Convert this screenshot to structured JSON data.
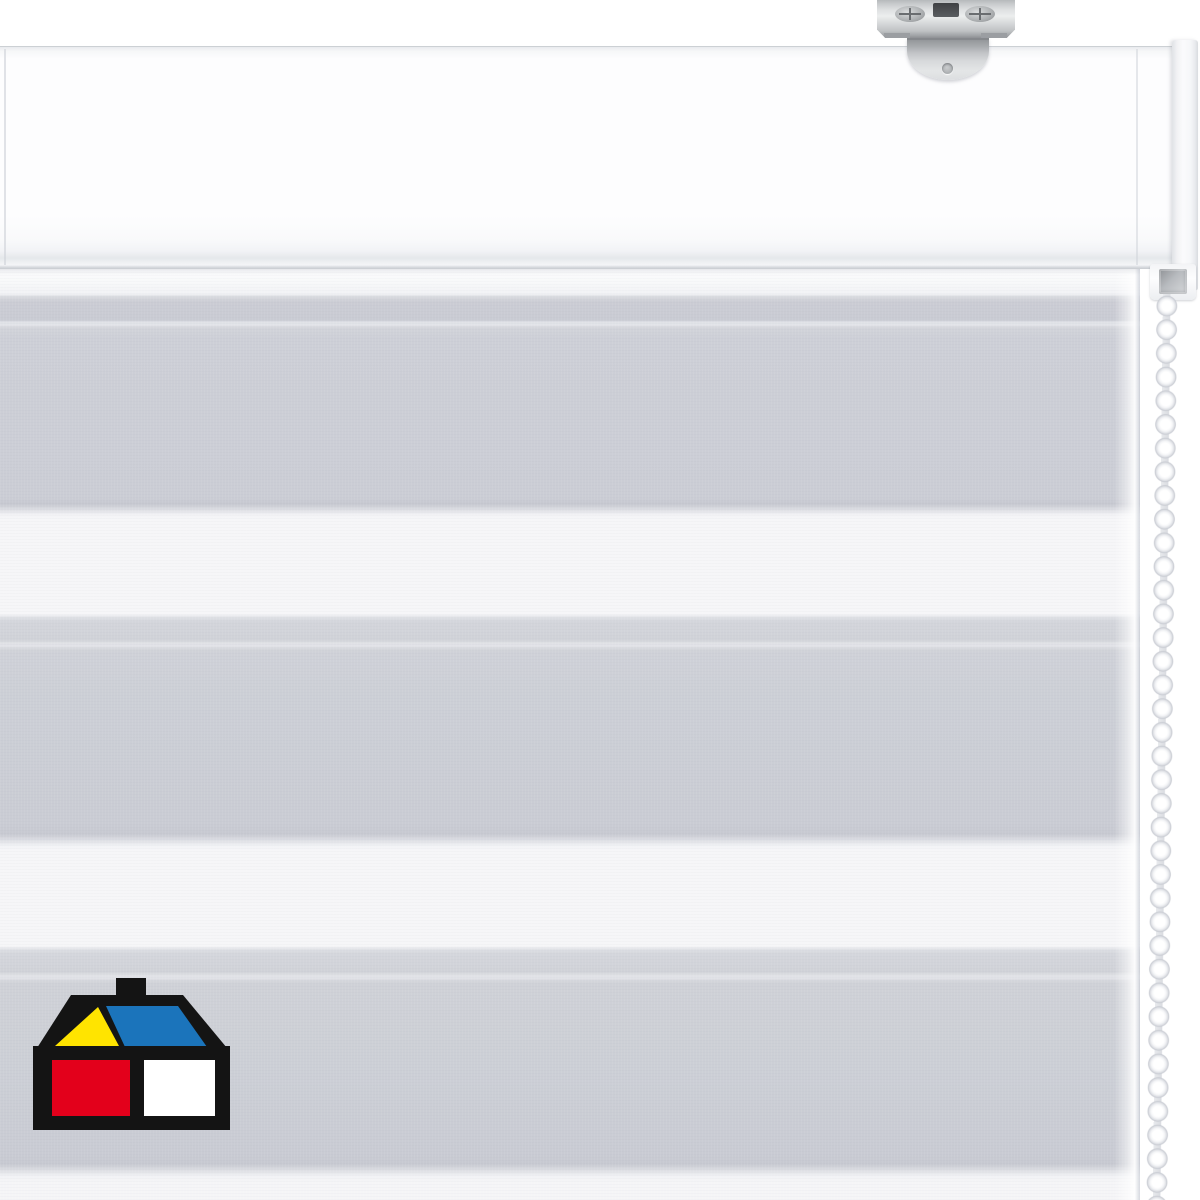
{
  "scene": {
    "type": "product-photo",
    "subject": "Day-and-night (zebra) roller blind, white, wall/ceiling mounted",
    "background_color": "#ffffff"
  },
  "blind": {
    "headrail": {
      "part": "white cassette headrail",
      "face_color": "#fdfdfe",
      "bottom_edge_color": "#c8cbd0",
      "endcap_color": "#f1f2f4"
    },
    "bracket": {
      "part": "metal mounting bracket with screws",
      "metal_color": "#d4d6d8",
      "slot_color": "#454749"
    },
    "chain": {
      "part": "plastic bead chain, right side",
      "bead_color": "#ffffff",
      "bead_shadow_color": "#c8cbd2",
      "approx_bead_count": 38
    },
    "fabric": {
      "part": "striped sheer/opaque fabric panel",
      "gray_band_color": "#cbcdd5",
      "white_band_color": "#f6f6f8",
      "seam_line_color": "#e2e3e8",
      "stripes_top_to_bottom": [
        {
          "type": "gray",
          "from_px": 296,
          "to_px": 512
        },
        {
          "type": "white",
          "from_px": 512,
          "to_px": 618
        },
        {
          "type": "gray",
          "from_px": 618,
          "to_px": 840
        },
        {
          "type": "white",
          "from_px": 840,
          "to_px": 948
        },
        {
          "type": "gray",
          "from_px": 948,
          "to_px": 1172
        },
        {
          "type": "white",
          "from_px": 1172,
          "to_px": 1200
        }
      ]
    }
  },
  "logo": {
    "name": "homecenter-sodimac-house-logo",
    "position": "bottom-left",
    "colors": {
      "outline": "#141414",
      "gable_triangle": "#ffe400",
      "roof": "#1b74bb",
      "window_left": "#e3001b",
      "window_right": "#ffffff"
    }
  }
}
